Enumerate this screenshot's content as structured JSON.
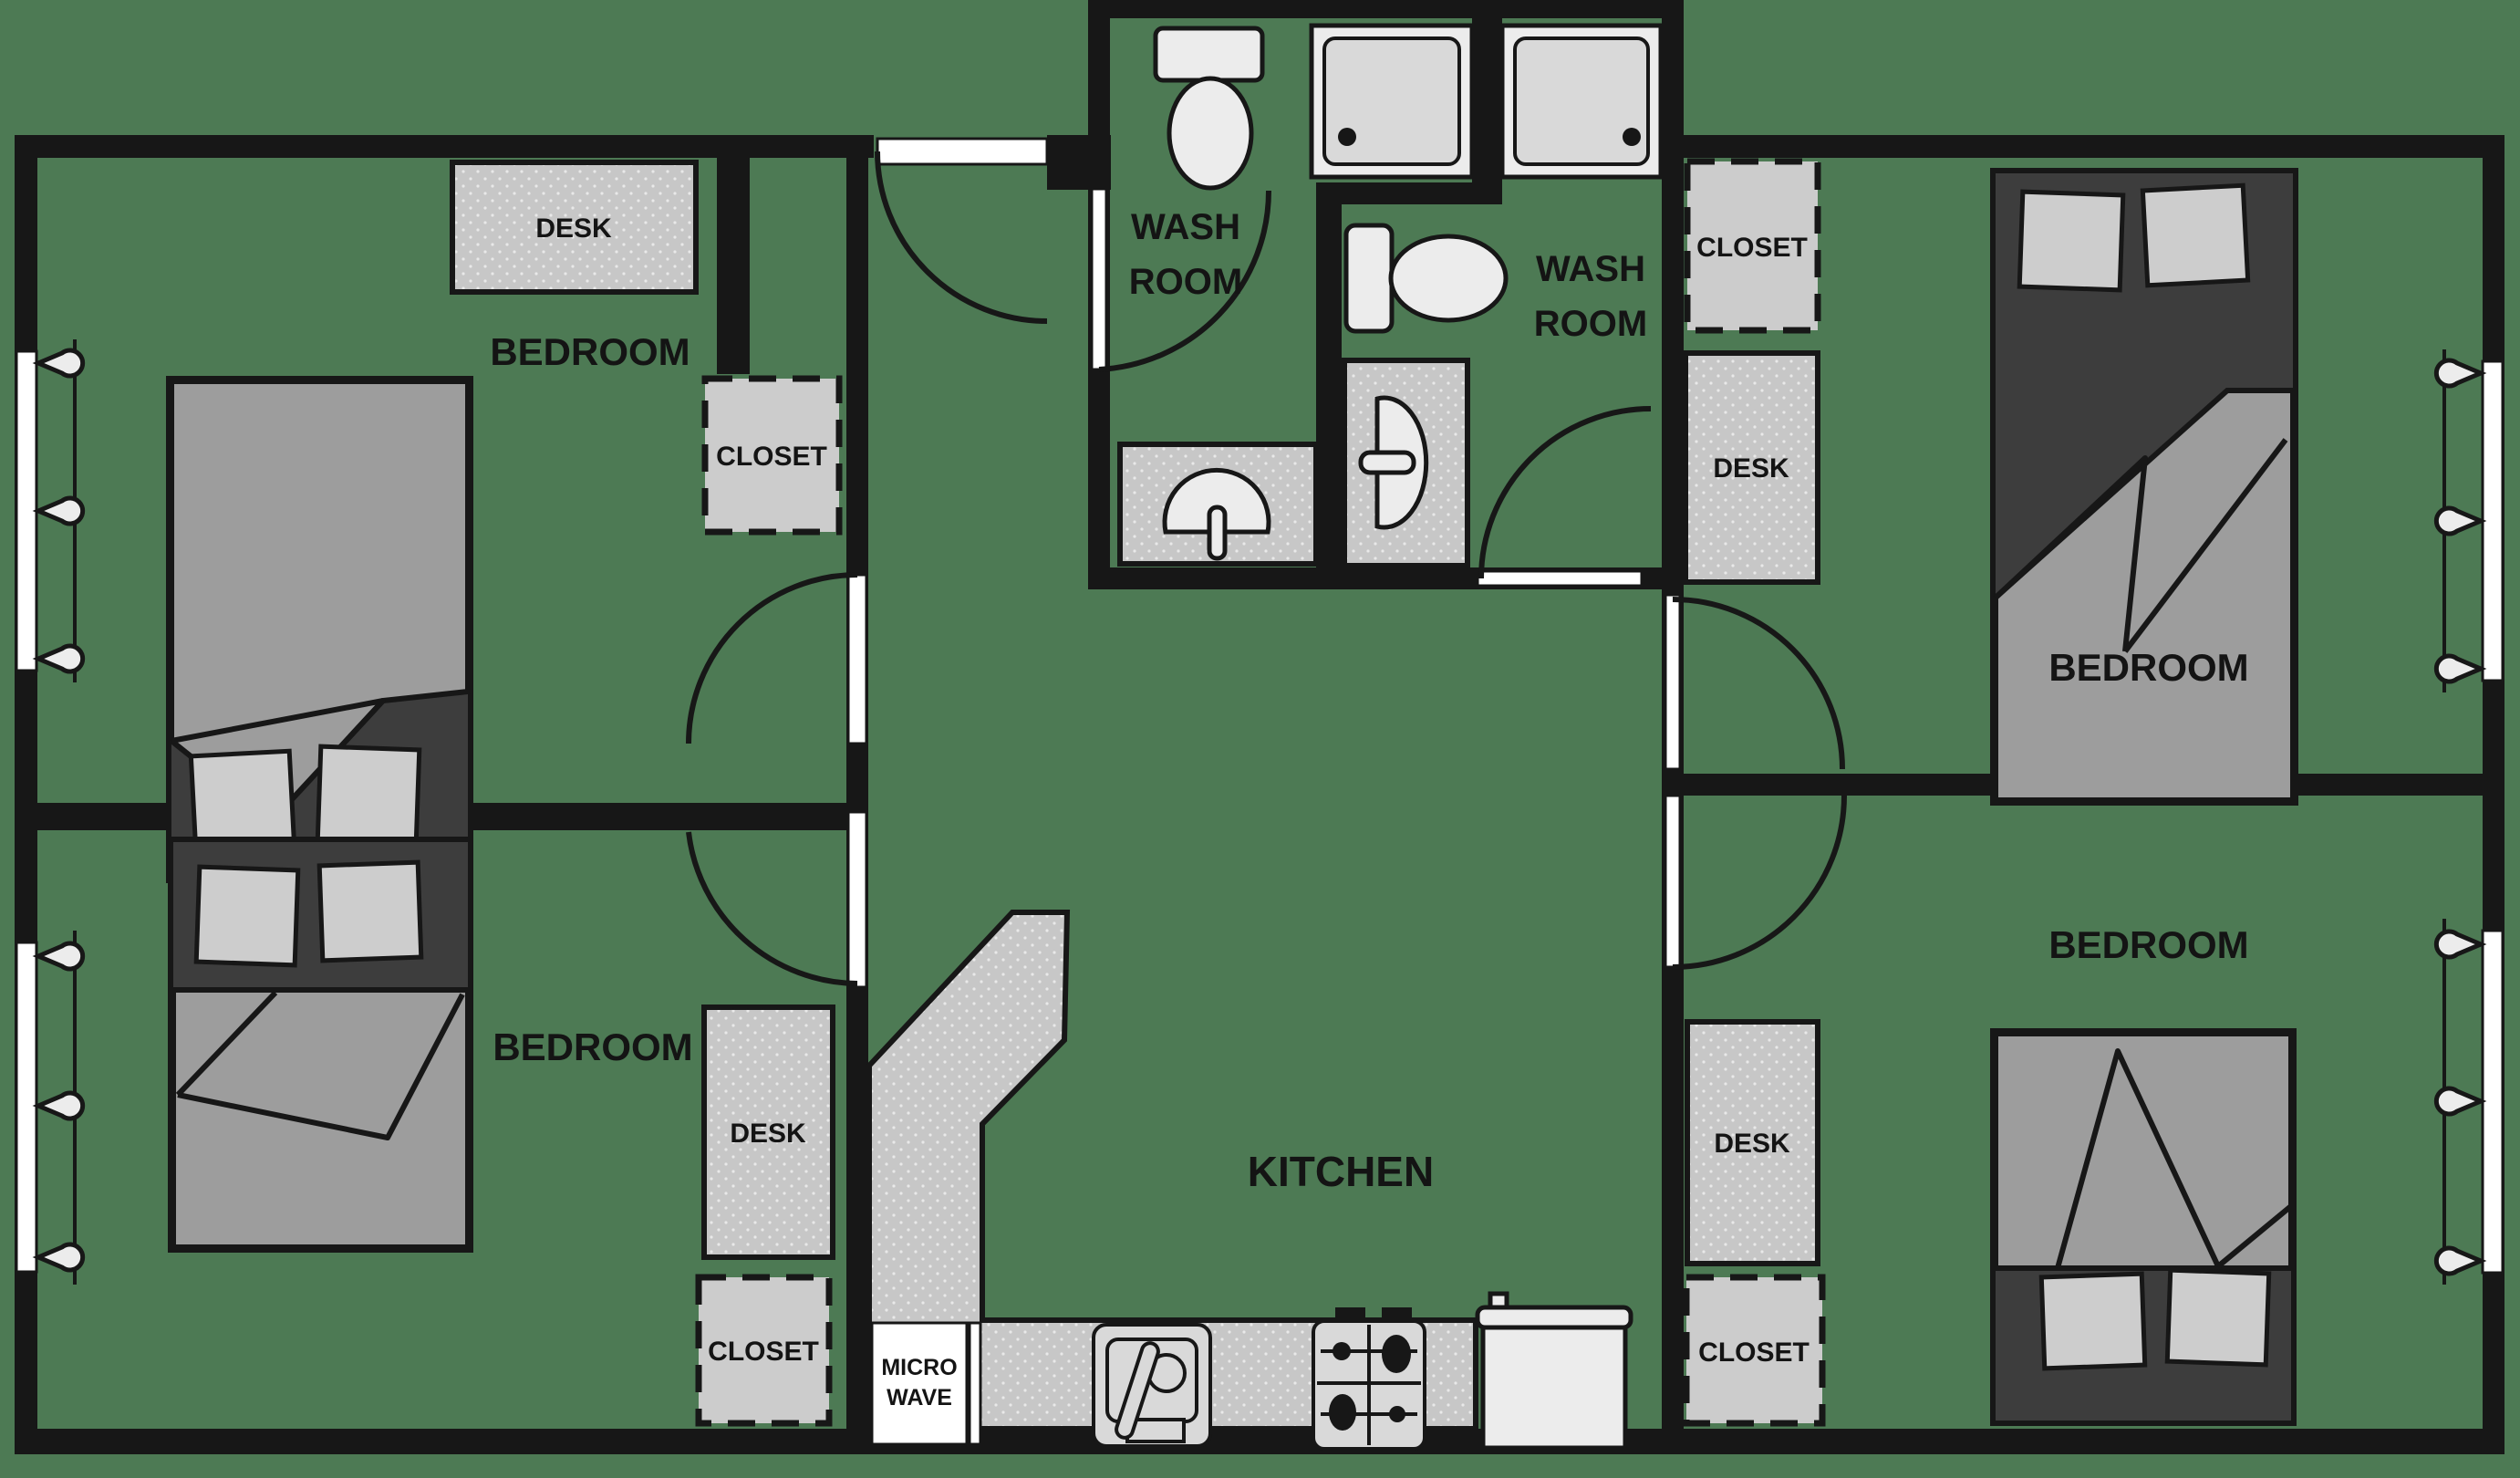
{
  "image_type": "apartment-floor-plan",
  "rooms": {
    "bedroom_top_left": {
      "label": "BEDROOM"
    },
    "bedroom_bottom_left": {
      "label": "BEDROOM"
    },
    "bedroom_top_right": {
      "label": "BEDROOM"
    },
    "bedroom_bottom_right": {
      "label": "BEDROOM"
    },
    "washroom_left": {
      "line1": "WASH",
      "line2": "ROOM"
    },
    "washroom_right": {
      "line1": "WASH",
      "line2": "ROOM"
    },
    "kitchen": {
      "label": "KITCHEN"
    }
  },
  "furniture": {
    "desk_top_left": {
      "label": "DESK"
    },
    "desk_bottom_left": {
      "label": "DESK"
    },
    "desk_top_right": {
      "label": "DESK"
    },
    "desk_bottom_right": {
      "label": "DESK"
    },
    "closet_top_left": {
      "label": "CLOSET"
    },
    "closet_bottom_left": {
      "label": "CLOSET"
    },
    "closet_top_right": {
      "label": "CLOSET"
    },
    "closet_bottom_right": {
      "label": "CLOSET"
    },
    "microwave": {
      "line1": "MICRO",
      "line2": "WAVE"
    }
  },
  "colors": {
    "background": "#4d7a54",
    "wall": "#171717",
    "furniture_gray": "#c7c7c7",
    "closet_gray": "#cccccc",
    "fixture_white": "#ececec",
    "blanket_gray": "#9d9d9d",
    "bed_frame_dark": "#3d3d3d",
    "pillow_gray": "#cdcdcd",
    "door_white": "#ffffff"
  }
}
